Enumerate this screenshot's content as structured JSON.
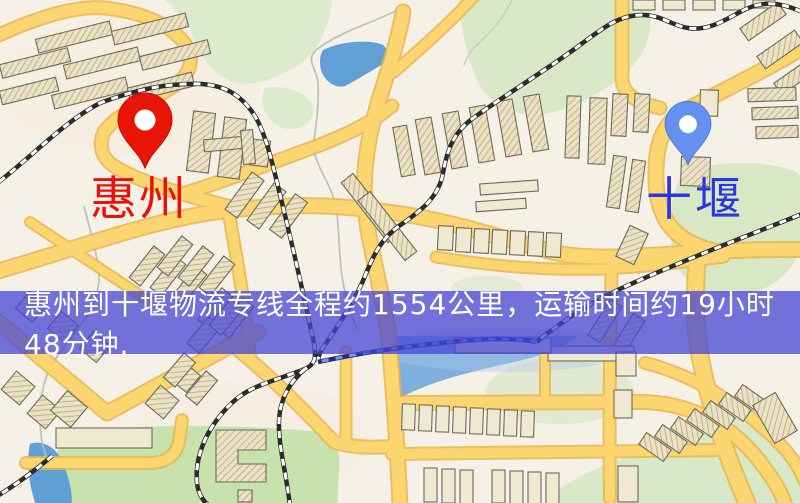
{
  "map": {
    "canvas_name": "stylized city street map",
    "colors": {
      "background": "#f6f1e7",
      "road_fill": "#fcd671",
      "road_casing": "#e9b64a",
      "building_fill": "#ebe2c4",
      "building_hatch": "#b3a781",
      "building_outline": "#6e6a59",
      "park_green": "#d9e9c8",
      "water_blue": "#61a0d4",
      "railway_dark": "#2b2b2b",
      "railway_water": "#1d2f7d"
    }
  },
  "markers": {
    "origin": {
      "label": "惠州",
      "pin_color": "#e81507",
      "pin_border": "#c11004",
      "label_color": "#ee0f06"
    },
    "destination": {
      "label": "十堰",
      "pin_color": "#6590f0",
      "pin_border": "#4a77dd",
      "label_color": "#2b36df"
    }
  },
  "banner": {
    "text": "惠州到十堰物流专线全程约1554公里，运输时间约19小时48分钟.",
    "background": "rgba(70,70,214,0.75)",
    "text_color": "#ffffff"
  }
}
